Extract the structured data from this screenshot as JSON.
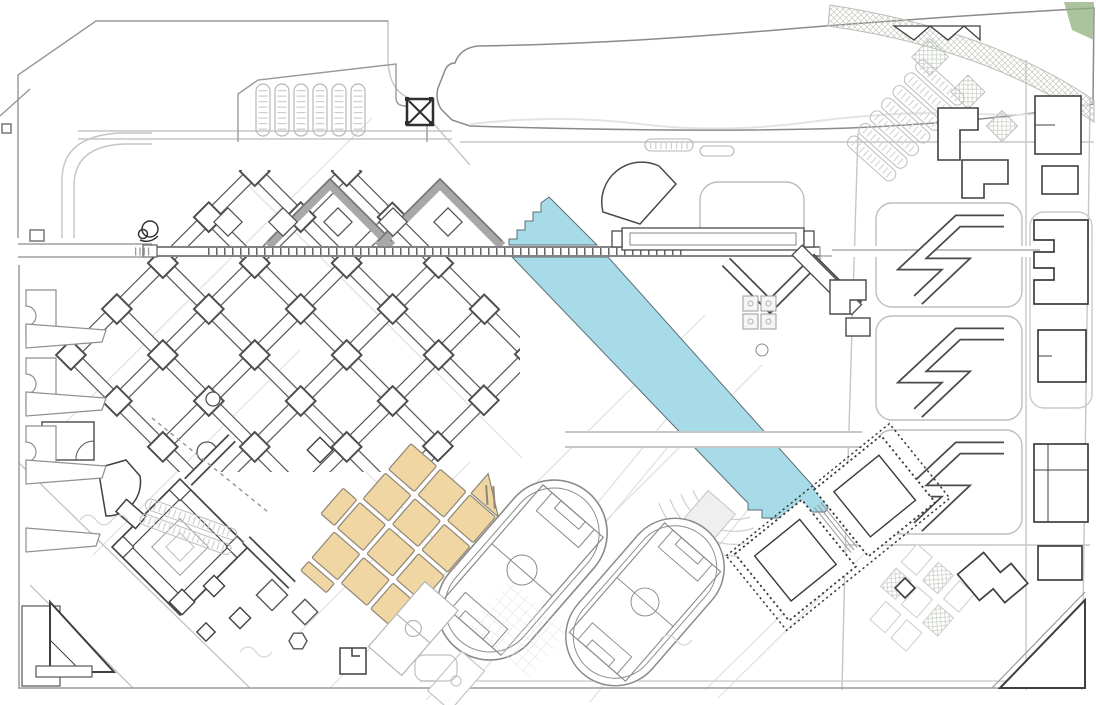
{
  "meta": {
    "type": "architectural-site-plan",
    "title": "Campus master plan site drawing",
    "visible_text_labels": []
  },
  "colors": {
    "background": "#ffffff",
    "water_fill": "#a7dbe7",
    "water_stroke": "#5d6e78",
    "site_fill": "#f0d6a2",
    "site_stroke": "#8f8678",
    "corner_green": "#8fb07c",
    "building_dark": "#3f3f3f",
    "building_mid": "#565656",
    "road_light": "#d2d2d2",
    "road_mid": "#9a9a9a",
    "axis_dark": "#5a5a5a",
    "hatch_light": "#c3cbc0",
    "court_fill": "#f5f5f5"
  },
  "features": {
    "water_canal": "diagonal canal, stepped head and foot, bridge crossings",
    "highlighted_site": "tan grid of 12 blocks (3 x 4) with striped gable tip, rotated 41 deg",
    "athletics": "two oval running tracks with soccer pitches, rotated 41 deg",
    "gymnasium": "two square halls with dotted colonnade enclosure",
    "academic_lattice": "diagonal waffle lattice of linked teaching buildings with node towers",
    "dormitories": "three blocks of zigzag slab housing plus east slab row",
    "parking_northwest": "six bus-parking comb rows",
    "gate_pavilion": "square pavilion with X cross at north entry",
    "green_belt": "curved hatched belt along north-east boundary",
    "amphitheatre": "concentric terraces facing canal foot",
    "courtyard_building": "concentric diamond courtyard building, south-west",
    "colonnade_axis": "long ticked east-west pedestrian axis"
  },
  "counts": {
    "site_blocks": 12,
    "running_tracks": 2,
    "gym_squares": 2,
    "bus_parking_rows": 6,
    "dorm_zigzag_blocks": 3
  }
}
